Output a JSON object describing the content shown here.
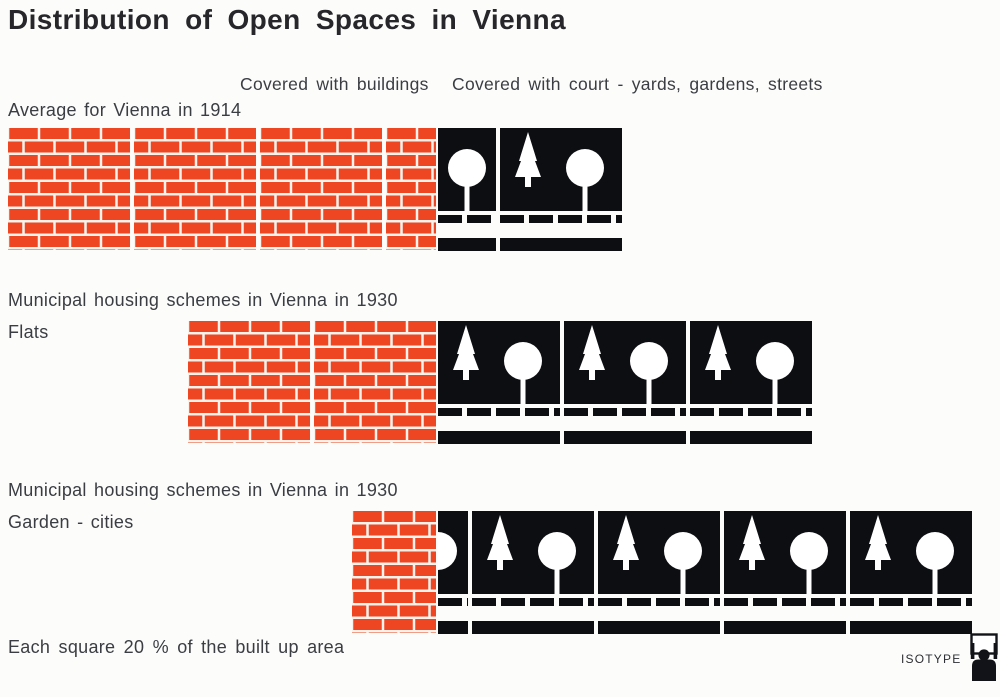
{
  "title": "Distribution of Open Spaces in Vienna",
  "legend": {
    "buildings": "Covered with buildings",
    "open": "Covered with court - yards, gardens, streets"
  },
  "rows": [
    {
      "label": "Average for Vienna in 1914",
      "sublabel": ""
    },
    {
      "label": "Municipal housing schemes in Vienna in 1930",
      "sublabel": "Flats"
    },
    {
      "label": "Municipal housing schemes in Vienna in 1930",
      "sublabel": "Garden - cities"
    }
  ],
  "footer": "Each square 20 % of the built up area",
  "logo_text": "ISOTYPE",
  "colors": {
    "brick_red": "#ee4623",
    "mortar_white": "#f6f3ec",
    "ink_black": "#0d0e12",
    "paper": "#fcfcfa",
    "label_text": "#3a3d43",
    "title_text": "#26262b"
  },
  "chart_data": {
    "type": "bar",
    "variant": "isotype-pictorial-stacked",
    "title": "Distribution of Open Spaces in Vienna",
    "unit_note": "Each square 20 % of the built up area",
    "square_value_pct": 20,
    "categories": [
      "Average for Vienna in 1914",
      "Municipal housing schemes in Vienna in 1930 — Flats",
      "Municipal housing schemes in Vienna in 1930 — Garden - cities"
    ],
    "series": [
      {
        "name": "Covered with buildings",
        "symbol": "brick wall square",
        "values_pct": [
          70,
          40,
          15
        ],
        "squares": [
          3.5,
          2,
          0.75
        ]
      },
      {
        "name": "Covered with court - yards, gardens, streets",
        "symbol": "black square with fir and round tree",
        "values_pct": [
          30,
          60,
          85
        ],
        "squares": [
          1.5,
          3,
          4.25
        ]
      }
    ],
    "legend_position": "top",
    "grid": false
  },
  "draw": {
    "square_px": 122,
    "rows": [
      {
        "bricks": [
          122,
          122,
          122,
          50
        ],
        "opens": [
          {
            "w": 58,
            "type": "round"
          },
          {
            "w": 122,
            "type": "fir_round"
          }
        ]
      },
      {
        "bricks": [
          122,
          122
        ],
        "opens": [
          {
            "w": 122,
            "type": "fir_round"
          },
          {
            "w": 122,
            "type": "fir_round"
          },
          {
            "w": 122,
            "type": "fir_round"
          }
        ]
      },
      {
        "bricks": [
          84
        ],
        "opens": [
          {
            "w": 30,
            "type": "round_clipped"
          },
          {
            "w": 122,
            "type": "fir_round"
          },
          {
            "w": 122,
            "type": "fir_round"
          },
          {
            "w": 122,
            "type": "fir_round"
          },
          {
            "w": 122,
            "type": "fir_round"
          }
        ]
      }
    ]
  }
}
